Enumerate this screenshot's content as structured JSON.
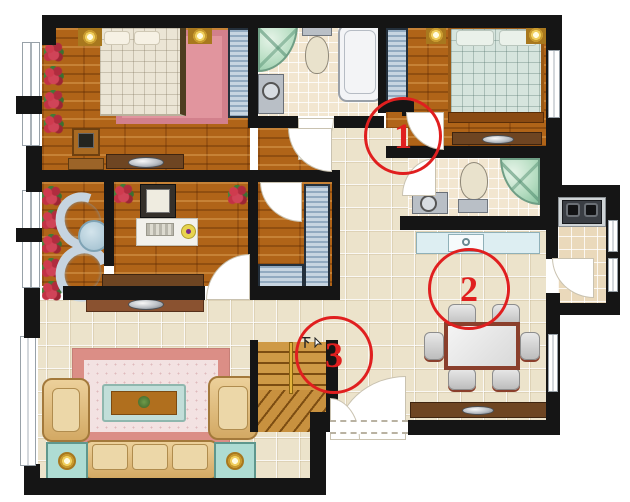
{
  "markers": [
    {
      "label": "1"
    },
    {
      "label": "2"
    },
    {
      "label": "3"
    }
  ],
  "stairs": {
    "direction_label": "下"
  },
  "colors": {
    "wall": "#151515",
    "marker_red": "#e01f1f",
    "wood_floor": "#b06418",
    "tile_floor": "#ece3cb",
    "bath_tile": "#f2e6d0",
    "rug_pink": "#db8e86",
    "wardrobe_blue": "#a9bfd2",
    "shower_green": "#b4dcc0",
    "sofa_tan": "#dcb77e",
    "bed_teal": "#d6e4dd",
    "bed_cream": "#ebe5d5"
  }
}
